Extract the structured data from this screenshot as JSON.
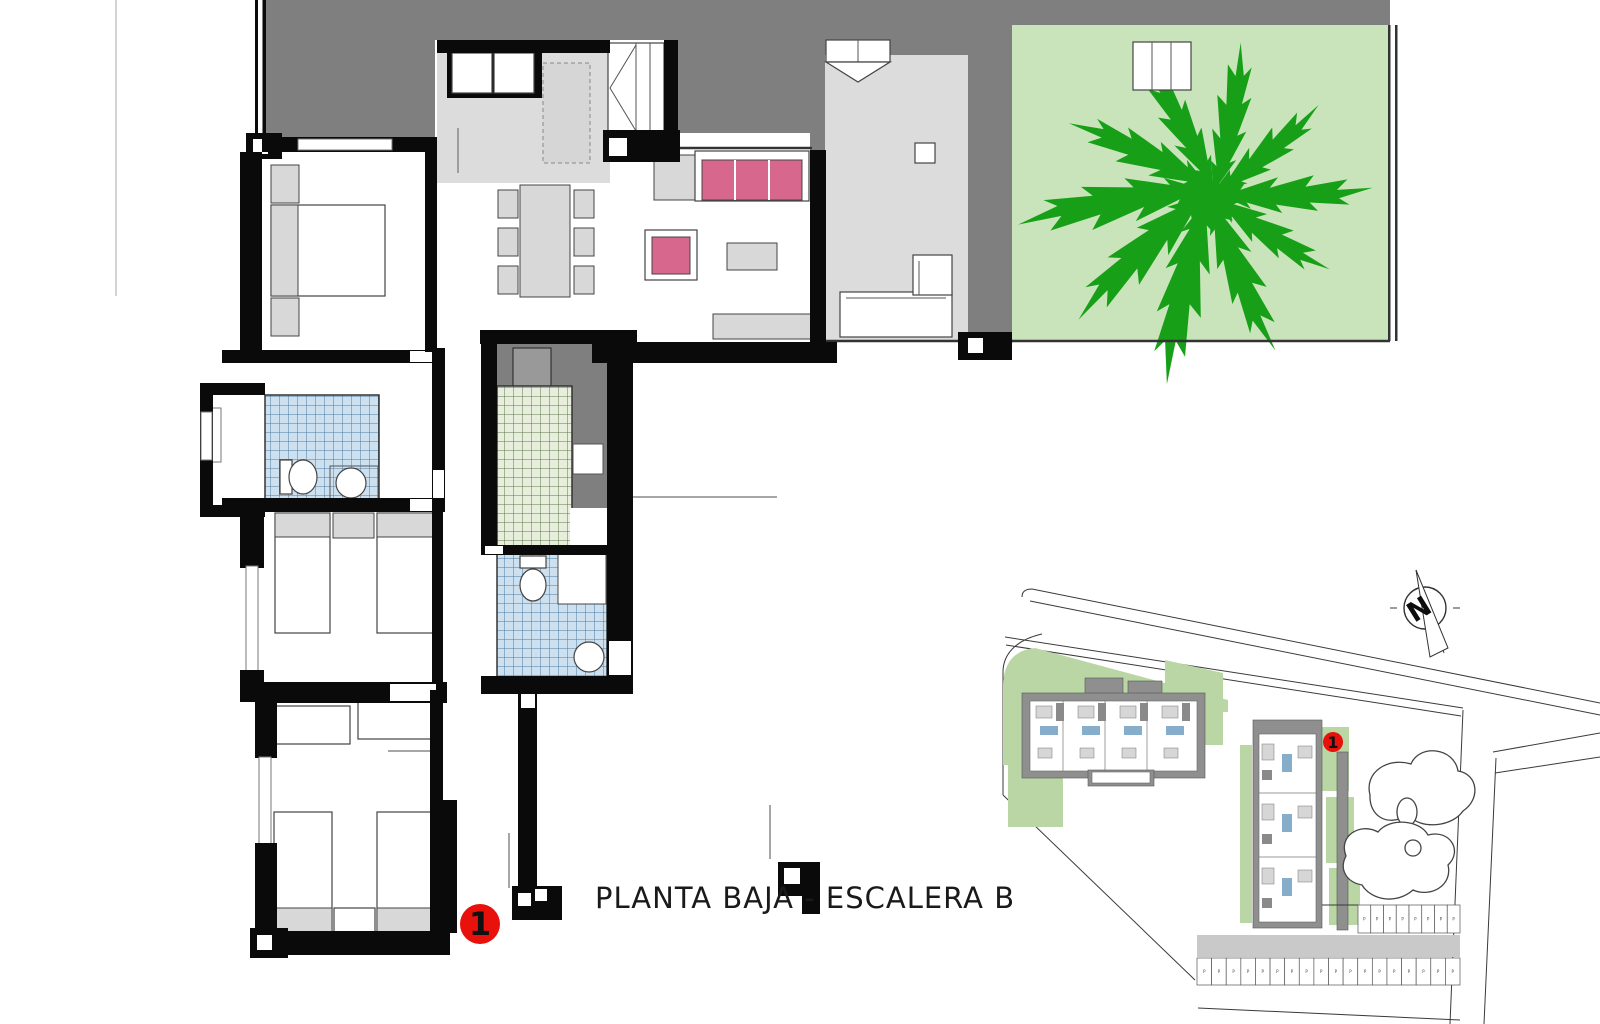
{
  "title": "PLANTA BAJA - ESCALERA B",
  "floor_plan": {
    "unit_marker": "1"
  },
  "site_plan": {
    "unit_marker": "1",
    "compass_label": "N",
    "parking": {
      "stall_label": "P",
      "upper_stalls": 8,
      "lower_stalls": 18
    }
  },
  "colors": {
    "ink": "#1a1a1a",
    "wall": "#0a0a0a",
    "exterior": "#7f7f7f",
    "floor_light": "#dcdcdc",
    "furniture_fill": "#d8d8d8",
    "furniture_stroke": "#444444",
    "pink": "#d7678d",
    "garden": "#c9e4ba",
    "tree": "#17a017",
    "tile_blue_bg": "#cce0ef",
    "tile_blue_line": "#4d7ba3",
    "tile_green_bg": "#e7efdc",
    "tile_green_line": "#62744f",
    "site_green": "#b9d6a4",
    "site_gray": "#8f8f8f",
    "site_blue": "#86aecb",
    "paving": "#c9c9c9",
    "marker_red": "#e8110c"
  }
}
